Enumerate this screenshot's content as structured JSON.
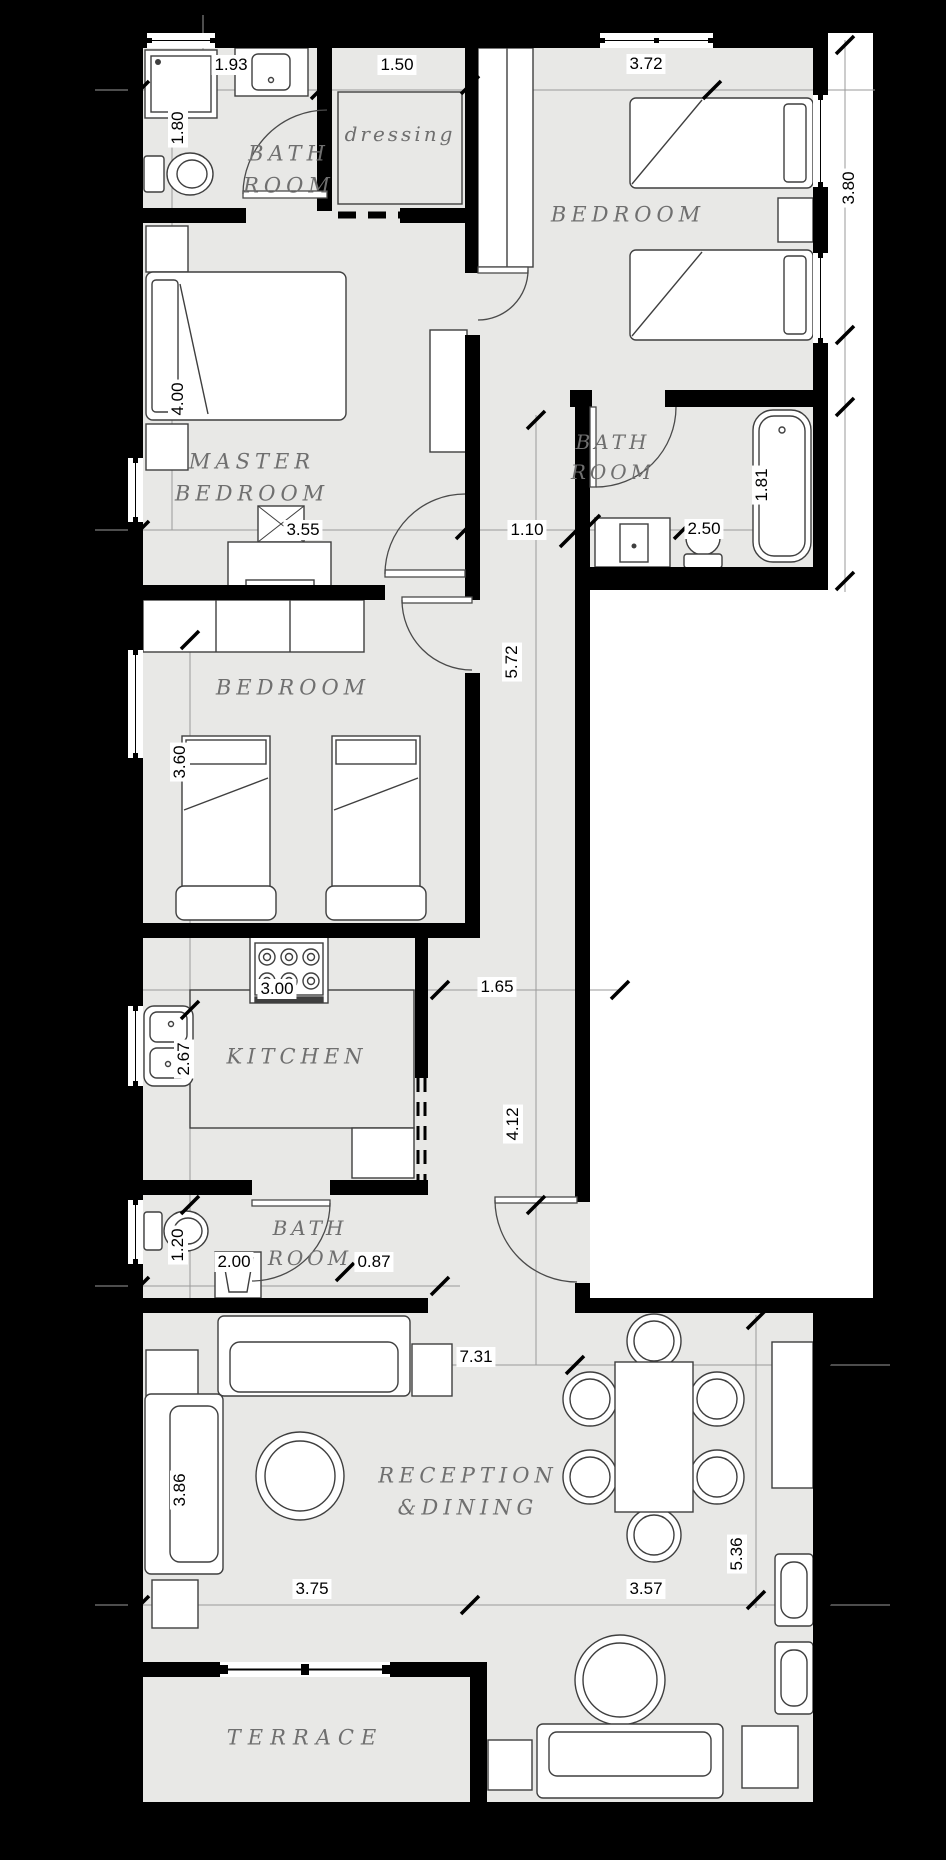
{
  "rooms": {
    "bath_top_left": {
      "line1": "BATH",
      "line2": "ROOM"
    },
    "dressing": {
      "name": "dressing"
    },
    "bedroom_top": {
      "name": "BEDROOM"
    },
    "master_bedroom": {
      "line1": "MASTER",
      "line2": "BEDROOM"
    },
    "bath_right": {
      "line1": "BATH",
      "line2": "ROOM"
    },
    "bedroom_mid": {
      "name": "BEDROOM"
    },
    "kitchen": {
      "name": "KITCHEN"
    },
    "bath_lower": {
      "line1": "BATH",
      "line2": "ROOM"
    },
    "reception": {
      "line1": "RECEPTION",
      "line2": "&DINING"
    },
    "terrace": {
      "name": "TERRACE"
    }
  },
  "dimensions": {
    "bath_top_width": "1.93",
    "dressing_width": "1.50",
    "bedroom_top_width": "3.72",
    "bath_top_height": "1.80",
    "bedroom_top_height": "3.80",
    "master_height": "4.00",
    "tub_length": "1.81",
    "bath_right_width": "2.50",
    "master_width": "3.55",
    "hall_width": "1.10",
    "hall_length": "5.72",
    "bedroom_mid_height": "3.60",
    "kitchen_width": "3.00",
    "hall_lower_width": "1.65",
    "kitchen_sink_height": "2.67",
    "hall_lower_length": "4.12",
    "bath_lower_height": "1.20",
    "bath_lower_width": "2.00",
    "bath_lower_door": "0.87",
    "reception_width": "7.31",
    "sofa_length": "3.86",
    "reception_left_width": "3.75",
    "reception_right_width": "3.57",
    "reception_right_height": "5.36"
  },
  "colors": {
    "background": "#000000",
    "floor": "#e8e8e6",
    "wall": "#000000",
    "furniture": "#ffffff",
    "outline": "#3f3f3f"
  }
}
